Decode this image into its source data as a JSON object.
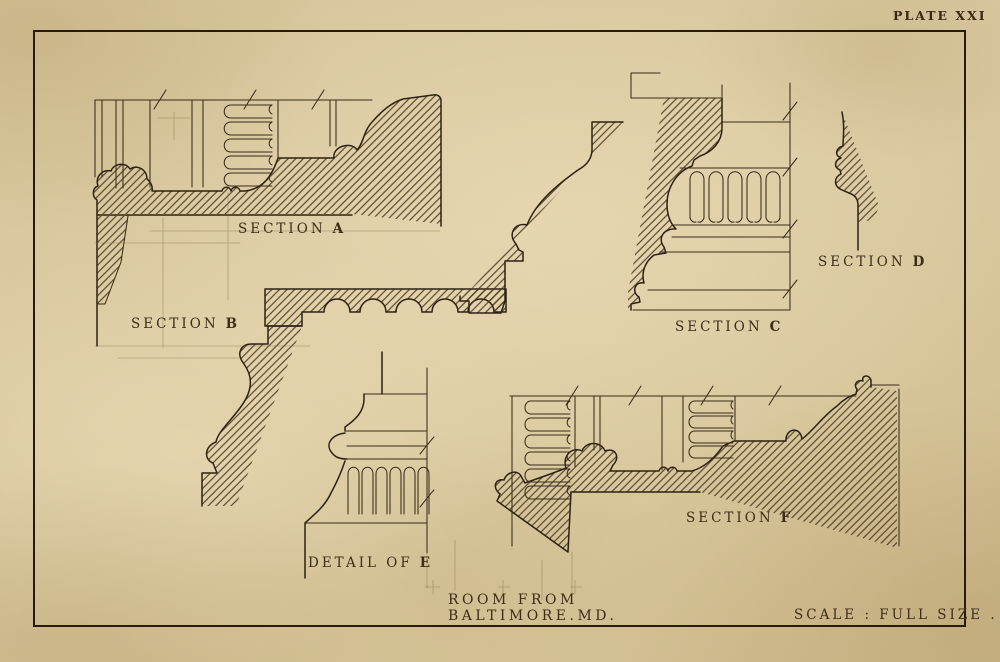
{
  "plate": {
    "number": "PLATE XXI",
    "caption": {
      "line1": "ROOM FROM",
      "line2": "BALTIMORE.MD."
    },
    "scale_note": "SCALE : FULL SIZE .",
    "sections": {
      "a": {
        "word": "SECTION",
        "letter": "A"
      },
      "b": {
        "word": "SECTION",
        "letter": "B"
      },
      "c": {
        "word": "SECTION",
        "letter": "C"
      },
      "d": {
        "word": "SECTION",
        "letter": "D"
      },
      "f": {
        "word": "SECTION",
        "letter": "F"
      },
      "e": {
        "word": "DETAIL OF",
        "letter": "E"
      }
    },
    "colors": {
      "paper": "#d8c69c",
      "ink": "#2d2213",
      "hatch": "#473621",
      "border": "#261b0e"
    }
  }
}
